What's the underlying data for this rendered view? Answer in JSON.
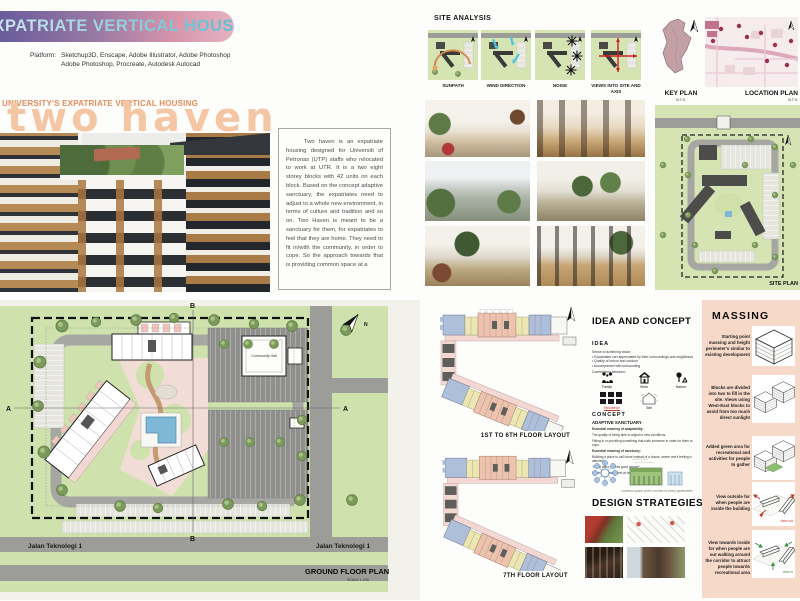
{
  "banner": {
    "title": "EXPATRIATE VERTICAL HOUSING"
  },
  "platform": {
    "label": "Platform:",
    "line1": "Sketchup3D, Enscape, Adobe Illustrator, Adobe Photoshop",
    "line2": "Adobe Photoshop, Procreate, Autodesk Autocad"
  },
  "project": {
    "eyebrow": "UNIVERSITY'S EXPATRIATE VERTICAL HOUSING",
    "title": "two haven",
    "description": "Two haven is an expatriate housing designed for Universiti of Petronas (UTP) staffs who relocated to work at UTR. It is a two eight storey blocks with 42 units on each block. Based on the concept adaptive sanctuary, the expatriates need to adjust to a whole new environment, in terms of culture and tradition and so on. Two Haven is meant to be a sanctuary for them, for expatriates to feel that they are home. They need to fit in/with the community, in order to cope. So the approach towards that is  providing common space at a"
  },
  "north_label": "N",
  "site_analysis": {
    "title": "SITE ANALYSIS",
    "diagrams": [
      {
        "label": "SUNPATH"
      },
      {
        "label": "WIND DIRECTION"
      },
      {
        "label": "NOISE"
      },
      {
        "label": "VIEWS INTO SITE AND AXIS"
      }
    ]
  },
  "key_plan": {
    "label": "KEY PLAN",
    "scale": "N.T.S."
  },
  "location_plan": {
    "label": "LOCATION PLAN",
    "scale": "N.T.S."
  },
  "site_plan": {
    "label": "SITE PLAN"
  },
  "ground_floor": {
    "label": "GROUND FLOOR PLAN",
    "scale": "SCALE 1:250",
    "road_left": "Jalan Teknologi 1",
    "road_right": "Jalan Teknologi 1",
    "section_a": "A",
    "section_b": "B",
    "community_hall": "Community Hall"
  },
  "floor_layouts": {
    "levels_1_6": "1ST  TO 6TH FLOOR LAYOUT",
    "level_7": "7TH FLOOR LAYOUT"
  },
  "idea_concept": {
    "title": "IDEA AND CONCEPT",
    "idea_heading": "IDEA",
    "idea_intro": "Sense of achieving vision:",
    "idea_points": [
      "Expatriates can appreciated by their surroundings and neighbours",
      "Quality of indoor and outdoor",
      "Accompanied with surrounding"
    ],
    "connections_label": "Connections between:",
    "icon_labels": [
      "Family",
      "Work",
      "Nature"
    ],
    "residence_label": "Residence",
    "site_label": "Site",
    "concept_heading": "CONCEPT",
    "concept_name": "ADAPTIVE SANCTUARY",
    "adaptability_heading": "Essential meaning of adaptability:",
    "adaptability_text": "The quality of being able to adjust to new conditions.",
    "fitting_text": "Fitting in or providing something that suits someone in order for them to cope.",
    "sanctuary_heading": "Essential meaning of sanctuary:",
    "sanctuary_text": "Building a place to call home instead of a house, where one's feeling is attached.",
    "quote": "\"Good place breeds good people\"",
    "closing": "Make expatriates feel at home.",
    "diagram_caption": "common space at the corridor of every apartments"
  },
  "design_strategies": {
    "title": "DESIGN STRATEGIES"
  },
  "massing": {
    "title": "MASSING",
    "steps": [
      {
        "text": "Starting point massing and height perimeter's similar to existing development"
      },
      {
        "text": "Blocks are divided into two to fill in the site. Views using West-East blocks to avoid from too much direct sunlight"
      },
      {
        "text": "Added green area for recreational and activities for people to gather"
      },
      {
        "text": "View outside for when people are inside the building"
      },
      {
        "text": "View towards inside for when people are out walking around the corridor to attract people towards recreational area"
      }
    ],
    "view_out_label": "view out",
    "view_in_label": "view in"
  },
  "colors": {
    "banner_purple": "#63589a",
    "banner_pink": "#e0a9bb",
    "accent_orange": "#e58c5a",
    "title_peach": "#f5c6a4",
    "massing_bg": "#f7d9ca",
    "green_field": "#cfe2ad",
    "road_gray": "#9c9c99",
    "pool_blue": "#7fb7d7"
  }
}
